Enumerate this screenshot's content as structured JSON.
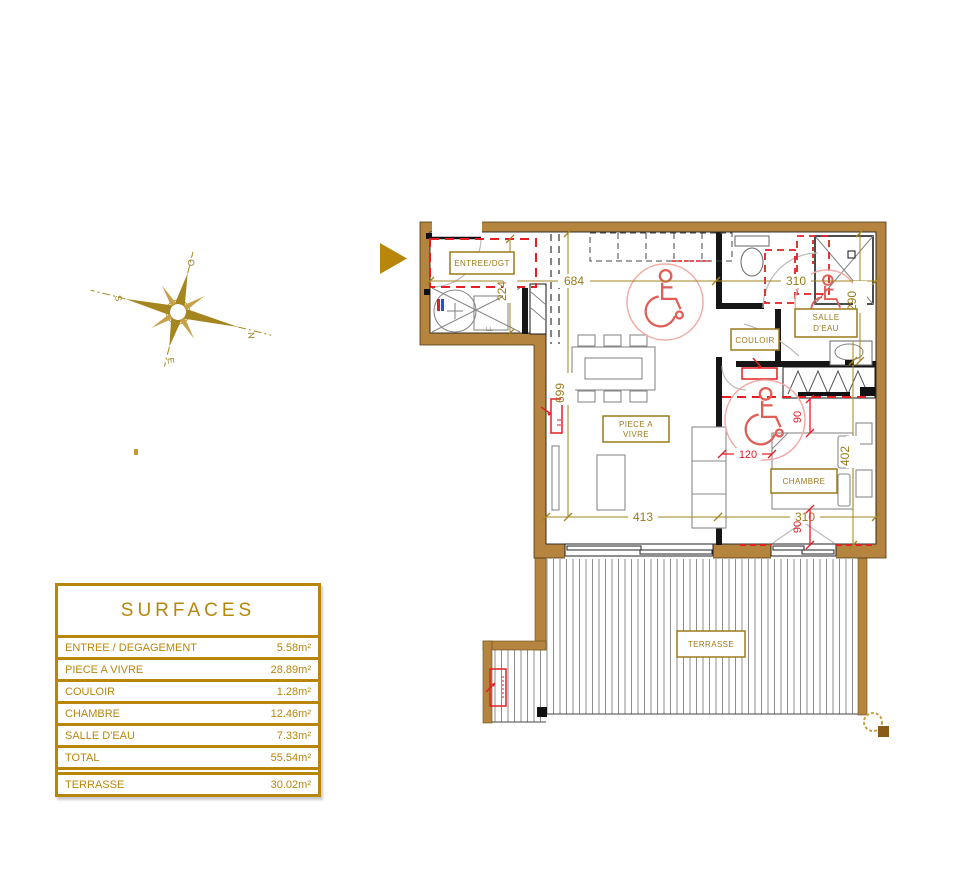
{
  "colors": {
    "gold": "#9c7a1a",
    "table_gold": "#b8860b",
    "wall_brown": "#b5853f",
    "red": "#e31e24",
    "pink": "#f2aba6"
  },
  "compass": {
    "n": "N",
    "s": "S",
    "e": "E",
    "o": "O"
  },
  "plan": {
    "rooms": {
      "entree": "ENTREE/DGT",
      "living1": "PIECE A",
      "living2": "VIVRE",
      "couloir": "COULOIR",
      "bath1": "SALLE",
      "bath2": "D'EAU",
      "chambre": "CHAMBRE",
      "terrasse": "TERRASSE"
    },
    "dims": {
      "d684": "684",
      "d310_top": "310",
      "d224": "224",
      "d290": "290",
      "d699": "699",
      "d413": "413",
      "d310_bottom": "310",
      "d402": "402",
      "d120": "120",
      "d90_upper": "90",
      "d90_lower": "90"
    },
    "annotations": {
      "washer": "LL"
    }
  },
  "surfaces": {
    "title": "SURFACES",
    "rows": [
      {
        "label": "ENTREE / DEGAGEMENT",
        "value": "5.58m²"
      },
      {
        "label": "PIECE A VIVRE",
        "value": "28.89m²"
      },
      {
        "label": "COULOIR",
        "value": "1.28m²"
      },
      {
        "label": "CHAMBRE",
        "value": "12.46m²"
      },
      {
        "label": "SALLE D'EAU",
        "value": "7.33m²"
      },
      {
        "label": "TOTAL",
        "value": "55.54m²"
      },
      {
        "label": "TERRASSE",
        "value": "30.02m²"
      }
    ]
  }
}
